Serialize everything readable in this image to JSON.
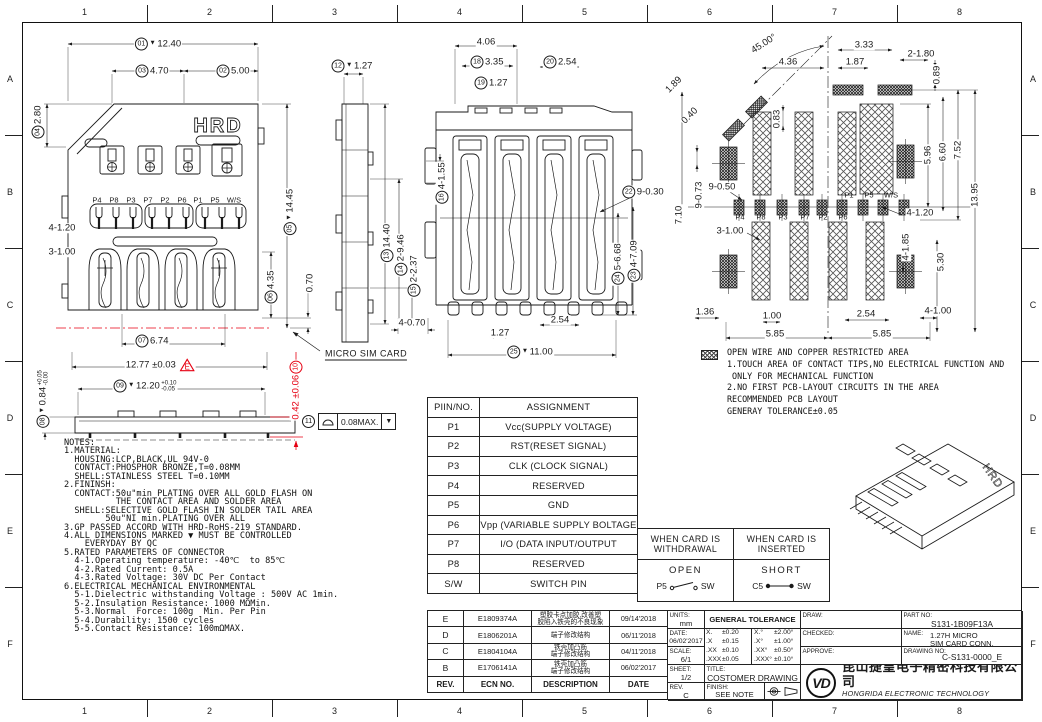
{
  "colors": {
    "accent_red": "#e60012",
    "line": "#1a1a1a"
  },
  "grid": {
    "cols": [
      "1",
      "2",
      "3",
      "4",
      "5",
      "6",
      "7",
      "8"
    ],
    "rows": [
      "A",
      "B",
      "C",
      "D",
      "E",
      "F"
    ]
  },
  "labels": {
    "hrd": "HRD"
  },
  "fcf": {
    "balloon": "11",
    "value": "0.08MAX.",
    "tri": "▼"
  },
  "notes": {
    "lines": [
      "NOTES:",
      "1.MATERIAL:",
      "  HOUSING:LCP,BLACK,UL 94V-0",
      "  CONTACT:PHOSPHOR BRONZE,T=0.08MM",
      "  SHELL:STAINLESS STEEL T=0.10MM",
      "2.FININSH:",
      "  CONTACT:50u\"min PLATING OVER ALL GOLD FLASH ON",
      "          THE CONTACT AREA AND SOLDER AREA",
      "  SHELL:SELECTIVE GOLD FLASH IN SOLDER TAIL AREA",
      "        50u\"NI min.PLATING OVER ALL",
      "3.GP PASSED ACCORD WITH HRD-RoHS-219 STANDARD.",
      "4.ALL DIMENSIONS MARKED ▼ MUST BE CONTROLLED",
      "    EVERYDAY BY QC",
      "5.RATED PARAMETERS OF CONNECTOR",
      "  4-1.Operating temperature: -40℃  to 85℃",
      "  4-2.Rated Current: 0.5A",
      "  4-3.Rated Voltage: 30V DC Per Contact",
      "6.ELECTRICAL MECHANICAL ENVIRONMENTAL",
      "  5-1.Dielectric withstanding Voltage : 500V AC 1min.",
      "  5-2.Insulation Resistance: 1000 MΩMin.",
      "  5-3.Normal  Force: 100g  Min. Per Pin",
      "  5-4.Durability: 1500 cycles",
      "  5-5.Contact Resistance: 100mΩMAX."
    ]
  },
  "legend": {
    "lines": [
      "OPEN WIRE AND COPPER RESTRICTED AREA",
      "1.TOUCH AREA OF CONTACT TIPS,NO ELECTRICAL FUNCTION AND",
      " ONLY FOR MECHANICAL FUNCTION",
      "2.NO FIRST PCB-LAYOUT CIRCUITS IN THE AREA",
      "RECOMMENDED PCB LAYOUT",
      "GENERAY TOLERANCE±0.05"
    ]
  },
  "pin_table": {
    "headers": [
      "PIIN/NO.",
      "ASSIGNMENT"
    ],
    "rows": [
      [
        "P1",
        "Vcc(SUPPLY VOLTAGE)"
      ],
      [
        "P2",
        "RST(RESET SIGNAL)"
      ],
      [
        "P3",
        "CLK (CLOCK SIGNAL)"
      ],
      [
        "P4",
        "RESERVED"
      ],
      [
        "P5",
        "GND"
      ],
      [
        "P6",
        "Vpp (VARIABLE SUPPLY BOLTAGE"
      ],
      [
        "P7",
        "I/O (DATA INPUT/OUTPUT"
      ],
      [
        "P8",
        "RESERVED"
      ],
      [
        "S/W",
        "SWITCH PIN"
      ]
    ]
  },
  "switch_table": {
    "withdrawn": {
      "title": "WHEN CARD IS\nWITHDRAWAL",
      "state": "OPEN",
      "from": "P5",
      "to": "SW"
    },
    "inserted": {
      "title": "WHEN CARD IS\nINSERTED",
      "state": "SHORT",
      "from": "C5",
      "to": "SW"
    }
  },
  "revision_table": {
    "headers": [
      "REV.",
      "ECN NO.",
      "DESCRIPTION",
      "DATE"
    ],
    "rows": [
      {
        "rev": "E",
        "ecn": "E1809374A",
        "desc": "塑胶卡点加胶,改善塑\n胶陷入铁壳的不良现象",
        "date": "09/14'2018"
      },
      {
        "rev": "D",
        "ecn": "E1806201A",
        "desc": "端子修改结构",
        "date": "06/11'2018"
      },
      {
        "rev": "C",
        "ecn": "E1804104A",
        "desc": "铁壳加凸筋\n端子修改结构",
        "date": "04/11'2018"
      },
      {
        "rev": "B",
        "ecn": "E1706141A",
        "desc": "铁壳加凸筋\n端子修改结构",
        "date": "06/02'2017"
      }
    ]
  },
  "title_block": {
    "units_label": "UNITS:",
    "units_value": "mm",
    "date_label": "DATE:",
    "date_value": "06/02'2017",
    "scale_label": "SCALE:",
    "scale_value": "6/1",
    "sheet_label": "SHEET:",
    "sheet_value": "1/2",
    "rev_label": "REV.",
    "rev_value": "C",
    "gt_label": "GENERAL TOLERANCE",
    "gt_rows": [
      [
        "X.",
        "±0.20",
        "X.°",
        "±2.00°"
      ],
      [
        ".X",
        "±0.15",
        ".X°",
        "±1.00°"
      ],
      [
        ".XX",
        "±0.10",
        ".XX°",
        "±0.50°"
      ],
      [
        ".XXX",
        "±0.05",
        ".XXX°",
        "±0.10°"
      ]
    ],
    "draw_label": "DRAW:",
    "checked_label": "CHECKED:",
    "approve_label": "APPROVE:",
    "part_no_label": "PART NO:",
    "part_no_value": "S131-1B09F13A",
    "name_label": "NAME:",
    "name_value": "1.27H MICRO\nSIM CARD CONN.",
    "drawing_no_label": "DRAWING NO:",
    "drawing_no_value": "C-S131-0000_E",
    "title_label": "TITLE:",
    "title_value": "COSTOMER DRAWING",
    "finish_label": "FINISH:",
    "finish_value": "SEE NOTE",
    "company_cn": "昆山捷皇电子精密科技有限公司",
    "company_en": "HONGRIDA ELECTRONIC TECHNOLOGY CO.,LTD.",
    "logo_text": "VD"
  },
  "dims": [
    {
      "t": "12.40",
      "b": "01",
      "v": 1,
      "x": 158,
      "y": 44
    },
    {
      "t": "4.70",
      "b": "03",
      "x": 152,
      "y": 71
    },
    {
      "t": "5.00",
      "b": "02",
      "x": 233,
      "y": 71
    },
    {
      "t": "2.80",
      "b": "04",
      "r": -90,
      "x": 38,
      "y": 122
    },
    {
      "t": "14.45",
      "b": "05",
      "v": 1,
      "r": -90,
      "x": 290,
      "y": 212
    },
    {
      "t": "4-1.20",
      "x": 62,
      "y": 228
    },
    {
      "t": "3-1.00",
      "x": 62,
      "y": 252
    },
    {
      "t": "4.35",
      "b": "06",
      "r": -90,
      "x": 271,
      "y": 287
    },
    {
      "t": "0.70",
      "r": -90,
      "x": 310,
      "y": 283
    },
    {
      "t": "6.74",
      "b": "07",
      "x": 152,
      "y": 341
    },
    {
      "t": "12.77 ±0.03",
      "f": "E",
      "x": 160,
      "y": 365
    },
    {
      "t": "12.20",
      "b": "09",
      "v": 1,
      "tol": {
        "u": "+0.10",
        "d": "-0.05"
      },
      "x": 145,
      "y": 386
    },
    {
      "t": "0.84",
      "b": "08",
      "v": 1,
      "tol": {
        "u": "+0.05",
        "d": "-0.00"
      },
      "r": -90,
      "x": 43,
      "y": 399
    },
    {
      "t": "0.42 ±0.06",
      "b": "10",
      "be": 1,
      "c": "#e60012",
      "r": -90,
      "x": 296,
      "y": 390
    },
    {
      "t": "MICRO SIM CARD",
      "cls": "lbl",
      "x": 366,
      "y": 355
    },
    {
      "t": "1.27",
      "b": "12",
      "v": 1,
      "x": 352,
      "y": 66
    },
    {
      "t": "14.40",
      "b": "13",
      "r": -90,
      "x": 387,
      "y": 243
    },
    {
      "t": "2-9.46",
      "b": "14",
      "r": -90,
      "x": 401,
      "y": 255
    },
    {
      "t": "2-2.37",
      "b": "15",
      "r": -90,
      "x": 414,
      "y": 276
    },
    {
      "t": "4-1.55",
      "b": "16",
      "r": -90,
      "x": 442,
      "y": 183
    },
    {
      "t": "4-0.70",
      "x": 412,
      "y": 323
    },
    {
      "t": "4.06",
      "x": 486,
      "y": 42
    },
    {
      "t": "3.35",
      "b": "18",
      "x": 487,
      "y": 62
    },
    {
      "t": "2.54",
      "b": "20",
      "x": 560,
      "y": 62
    },
    {
      "t": "1.27",
      "b": "19",
      "x": 491,
      "y": 83
    },
    {
      "t": "9-0.30",
      "b": "22",
      "x": 643,
      "y": 192
    },
    {
      "t": "5-6.68",
      "b": "24",
      "r": -90,
      "x": 618,
      "y": 264
    },
    {
      "t": "4-7.09",
      "b": "23",
      "r": -90,
      "x": 634,
      "y": 261
    },
    {
      "t": "2.54",
      "x": 560,
      "y": 320
    },
    {
      "t": "1.27",
      "x": 500,
      "y": 333
    },
    {
      "t": "11.00",
      "b": "25",
      "v": 1,
      "x": 530,
      "y": 352
    },
    {
      "t": "45.00°",
      "r": -33,
      "x": 764,
      "y": 44
    },
    {
      "t": "4.36",
      "x": 788,
      "y": 62
    },
    {
      "t": "3.33",
      "x": 864,
      "y": 45
    },
    {
      "t": "1.87",
      "x": 855,
      "y": 62
    },
    {
      "t": "2-1.80",
      "x": 921,
      "y": 54
    },
    {
      "t": "0.89",
      "r": -90,
      "x": 937,
      "y": 75
    },
    {
      "t": "1.89",
      "r": -45,
      "x": 674,
      "y": 85
    },
    {
      "t": "0.40",
      "r": -45,
      "x": 690,
      "y": 116
    },
    {
      "t": "0.83",
      "r": -90,
      "x": 777,
      "y": 119
    },
    {
      "t": "5.96",
      "r": -90,
      "x": 928,
      "y": 155
    },
    {
      "t": "6.60",
      "r": -90,
      "x": 943,
      "y": 152
    },
    {
      "t": "7.52",
      "r": -90,
      "x": 958,
      "y": 150
    },
    {
      "t": "13.95",
      "r": -90,
      "x": 975,
      "y": 195
    },
    {
      "t": "9-0.73",
      "r": -90,
      "x": 699,
      "y": 195
    },
    {
      "t": "9-0.50",
      "x": 722,
      "y": 187
    },
    {
      "t": "7.10",
      "r": -90,
      "x": 679,
      "y": 215
    },
    {
      "t": "3-1.00",
      "x": 730,
      "y": 231
    },
    {
      "t": "4-1.20",
      "x": 920,
      "y": 213
    },
    {
      "t": "4-1.85",
      "r": -90,
      "x": 906,
      "y": 247
    },
    {
      "t": "5.30",
      "r": -90,
      "x": 941,
      "y": 262
    },
    {
      "t": "1.36",
      "x": 705,
      "y": 312
    },
    {
      "t": "1.00",
      "x": 772,
      "y": 316
    },
    {
      "t": "2.54",
      "x": 866,
      "y": 314
    },
    {
      "t": "4-1.00",
      "x": 938,
      "y": 311
    },
    {
      "t": "5.85",
      "x": 775,
      "y": 334
    },
    {
      "t": "5.85",
      "x": 882,
      "y": 334
    },
    {
      "t": "P4",
      "cls": "pin",
      "x": 97,
      "y": 200
    },
    {
      "t": "P8",
      "cls": "pin",
      "x": 114,
      "y": 200
    },
    {
      "t": "P3",
      "cls": "pin",
      "x": 131,
      "y": 200
    },
    {
      "t": "P7",
      "cls": "pin",
      "x": 148,
      "y": 200
    },
    {
      "t": "P2",
      "cls": "pin",
      "x": 165,
      "y": 200
    },
    {
      "t": "P6",
      "cls": "pin",
      "x": 182,
      "y": 200
    },
    {
      "t": "P1",
      "cls": "pin",
      "x": 198,
      "y": 200
    },
    {
      "t": "P5",
      "cls": "pin",
      "x": 215,
      "y": 200
    },
    {
      "t": "W/S",
      "cls": "pin",
      "x": 234,
      "y": 200
    },
    {
      "t": "P4",
      "cls": "pin",
      "x": 740,
      "y": 217
    },
    {
      "t": "P8",
      "cls": "pin",
      "x": 761,
      "y": 217
    },
    {
      "t": "P3",
      "cls": "pin",
      "x": 783,
      "y": 217
    },
    {
      "t": "P7",
      "cls": "pin",
      "x": 805,
      "y": 217
    },
    {
      "t": "P2",
      "cls": "pin",
      "x": 823,
      "y": 217
    },
    {
      "t": "P6",
      "cls": "pin",
      "x": 843,
      "y": 217
    },
    {
      "t": "P1",
      "cls": "pin",
      "x": 849,
      "y": 195
    },
    {
      "t": "P5",
      "cls": "pin",
      "x": 869,
      "y": 195
    },
    {
      "t": "W/S",
      "cls": "pin",
      "x": 891,
      "y": 195
    }
  ]
}
